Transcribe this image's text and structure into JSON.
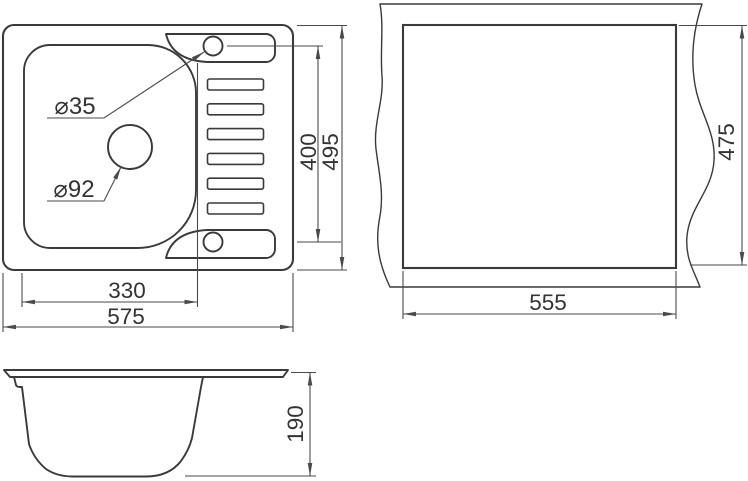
{
  "drawing": {
    "top_view": {
      "labels": {
        "faucet_hole_diameter": "⌀35",
        "drain_hole_diameter": "⌀92",
        "bowl_width": "330",
        "overall_width": "575",
        "hole_centers_span": "400",
        "overall_depth": "495"
      }
    },
    "cutout_view": {
      "labels": {
        "cutout_width": "555",
        "cutout_depth": "475"
      }
    },
    "side_view": {
      "labels": {
        "bowl_height": "190"
      }
    }
  },
  "colors": {
    "background": "#ffffff",
    "object_line": "#3a3a3a",
    "dimension_line": "#4a4a4a",
    "text": "#333333"
  }
}
